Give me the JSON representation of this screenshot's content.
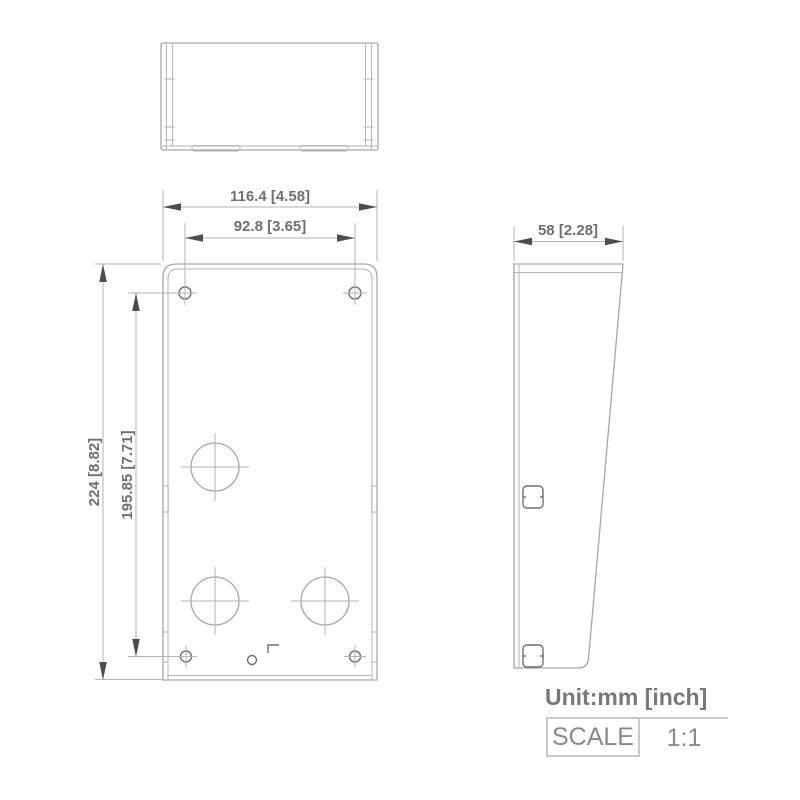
{
  "drawing": {
    "unit_note": "Unit:mm [inch]",
    "scale": {
      "label": "SCALE",
      "value": "1:1"
    },
    "dimensions": {
      "overall_width": "116.4 [4.58]",
      "mount_hole_spacing_width": "92.8 [3.65]",
      "overall_height": "224 [8.82]",
      "mount_hole_spacing_height": "195.85 [7.71]",
      "depth": "58 [2.28]"
    },
    "colors": {
      "outline_gray": "#a6a6a6",
      "extension_gray": "#b3b3b3",
      "arrow_dark": "#4d4d4d",
      "text_gray": "#6f6f6f",
      "note_gray": "#787878",
      "table_border": "#c9c9c9"
    }
  }
}
